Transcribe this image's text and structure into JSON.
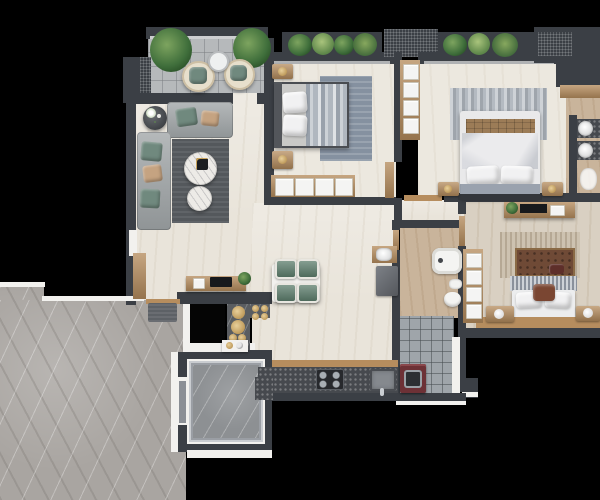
{
  "scene": {
    "title": "3D apartment floor plan render, top-down view on black background",
    "type": "architectural-floor-plan"
  },
  "palette": {
    "wall": "#3b3f45",
    "wall2": "#474b52",
    "trim": "#f2f1ee",
    "wood": "#b68d5e",
    "floorCream": "#e9e4da",
    "floorCream2": "#ece8df",
    "floorBeige": "#d9d0c2",
    "floorTan": "#c9b49b",
    "marble": "#a9a5a1",
    "tileBalcony": "#b6b9bb",
    "tileUtility": "#9fa5aa",
    "elev": "#8d9093",
    "rugDark": "#54585c",
    "rugBlue": "#8591a0",
    "rugLight": "#b4bac1",
    "rugWoven": "#cdc2b0",
    "sofa": "#9ca1a3",
    "pillowGreen": "#70897e",
    "pillowTan": "#c5a381",
    "chairGreen": "#5c7d6c",
    "counter": "#46494e",
    "plaid": "#9c7c57",
    "headboard3": "#6f4a36",
    "washer": "#6d3136",
    "plantGreen": "#4e7c46"
  },
  "rooms": [
    {
      "name": "Balcony",
      "items": [
        "potted plant",
        "potted plant",
        "rattan chair",
        "rattan chair",
        "round table",
        "tiled floor"
      ]
    },
    {
      "name": "Living Room",
      "items": [
        "L-shaped sectional sofa",
        "green and tan pillows",
        "dark area rug",
        "round marble coffee table",
        "round marble coffee table",
        "flower side table",
        "media console",
        "tall cabinet"
      ]
    },
    {
      "name": "Bedroom 2",
      "items": [
        "double bed",
        "white pillows",
        "striped duvet",
        "nightstand",
        "nightstand",
        "wardrobe",
        "blue-gray rug",
        "window planter"
      ]
    },
    {
      "name": "Master Bedroom",
      "items": [
        "double bed",
        "plaid throw band",
        "white pillows",
        "nightstand",
        "nightstand",
        "mottled gray rug",
        "linen shelf",
        "window planter"
      ]
    },
    {
      "name": "Ensuite Bathroom",
      "items": [
        "round basin",
        "round basin",
        "vanity counter",
        "toilet",
        "wood shelf"
      ]
    },
    {
      "name": "Bedroom 3",
      "items": [
        "double bed",
        "tufted brown headboard",
        "accent pillows",
        "nightstand with lamp",
        "nightstand with lamp",
        "TV console",
        "woven rug",
        "towel shelf",
        "storage bench"
      ]
    },
    {
      "name": "Bathroom",
      "items": [
        "bathtub",
        "toilet",
        "washbasin",
        "basin nook",
        "utility cabinet"
      ]
    },
    {
      "name": "Utility Room",
      "items": [
        "washing machine",
        "gray tiled floor"
      ]
    },
    {
      "name": "Kitchen",
      "items": [
        "dark countertop",
        "four-burner hob",
        "kitchen sink"
      ]
    },
    {
      "name": "Dining Area",
      "items": [
        "white dining table",
        "green chair",
        "green chair",
        "green chair",
        "green chair"
      ]
    },
    {
      "name": "Entry",
      "items": [
        "console table with TV",
        "doormat",
        "wood threshold",
        "decorative dark marble floor with wood discs",
        "service shaft"
      ]
    },
    {
      "name": "Elevator",
      "items": [
        "elevator cab",
        "marble cab floor",
        "sliding door"
      ]
    },
    {
      "name": "Corridor",
      "items": [
        "gray marble common floor"
      ]
    }
  ]
}
